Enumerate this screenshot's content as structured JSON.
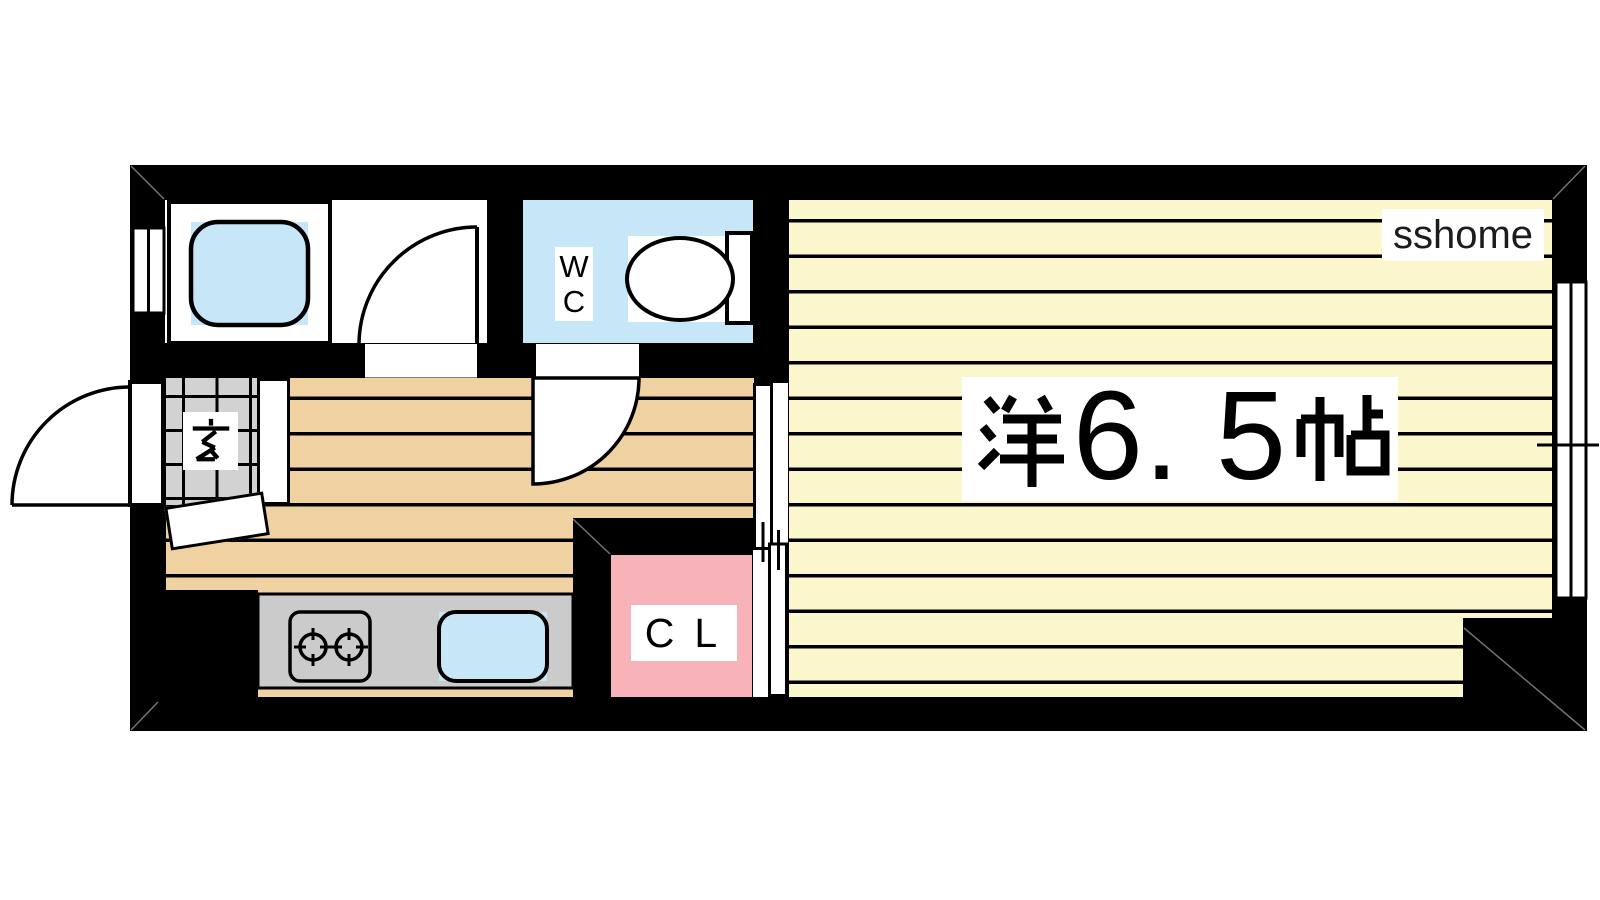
{
  "floorplan": {
    "watermark": "sshome",
    "rooms": {
      "main": {
        "label": "洋6.5帖",
        "label_kanji_prefix": "洋",
        "label_size": "6. 5",
        "label_kanji_suffix": "帖"
      },
      "wc": {
        "label": "WC",
        "stacked": [
          "W",
          "C"
        ]
      },
      "closet": {
        "label": "CL"
      },
      "genkan": {
        "label": "玄"
      },
      "bathroom": {
        "label": ""
      },
      "kitchen": {
        "label": ""
      }
    },
    "colors": {
      "wall": "#000000",
      "main_room_yellow": "#FCF6CD",
      "kitchen_tan": "#F0D2A2",
      "water_blue": "#C7E6F7",
      "closet_pink": "#F8B3BA",
      "genkan_tile_gray": "#D2D2D2",
      "counter_gray": "#CBCBCB"
    }
  }
}
